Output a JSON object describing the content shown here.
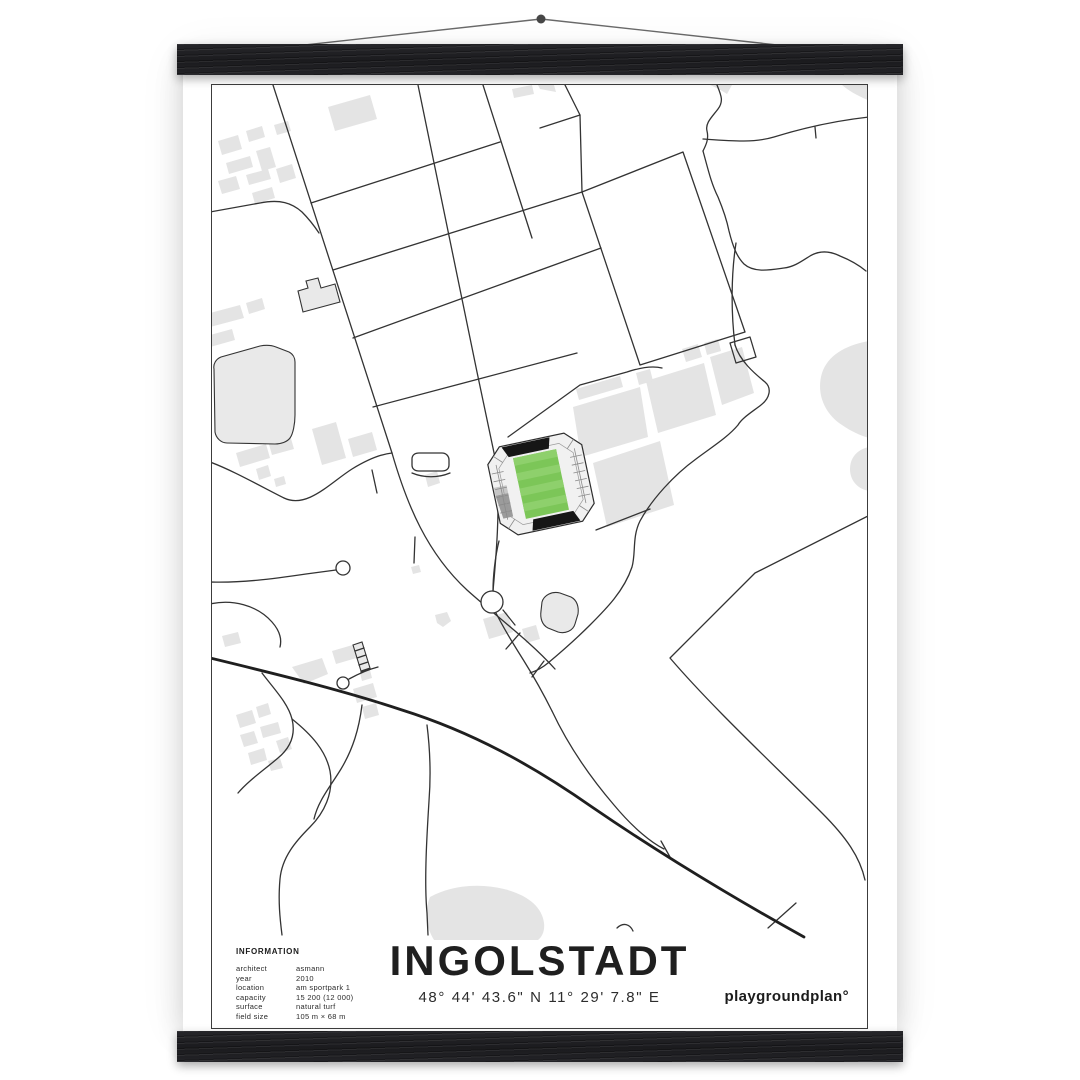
{
  "poster": {
    "title": "INGOLSTADT",
    "coordinates": "48° 44' 43.6\" N  11° 29' 7.8\" E",
    "brand": "playgroundplan°",
    "info": {
      "heading": "INFORMATION",
      "rows": [
        {
          "label": "architect",
          "value": "asmann"
        },
        {
          "label": "year",
          "value": "2010"
        },
        {
          "label": "location",
          "value": "am sportpark 1"
        },
        {
          "label": "capacity",
          "value": "15 200 (12 000)"
        },
        {
          "label": "surface",
          "value": "natural turf"
        },
        {
          "label": "field size",
          "value": "105 m × 68 m"
        }
      ]
    }
  },
  "colors": {
    "paper": "#ffffff",
    "bar": "#1e1e20",
    "road": "#333333",
    "road_dark": "#1f1f1f",
    "building": "#e4e4e4",
    "building_outlined": "#e9e9e9",
    "pitch": "#7cc658",
    "pitch_stripe": "#8ed06c",
    "stand_black": "#161616",
    "stand_gray": "#9b9b9b"
  },
  "map": {
    "viewbox": "0 0 655 855",
    "buildings": [
      "M6,56 L26,50 L30,64 L10,70 Z",
      "M34,46 L50,41 L53,52 L37,57 Z",
      "M14,78 L38,71 L41,82 L17,89 Z",
      "M44,66 L58,62 L64,82 L50,86 Z",
      "M6,96 L24,91 L28,104 L10,109 Z",
      "M34,90 L56,84 L59,94 L37,100 Z",
      "M62,40 L76,36 L79,46 L65,50 Z",
      "M64,84 L80,79 L84,93 L68,98 Z",
      "M40,108 L60,102 L63,113 L43,119 Z",
      "M116,22 L158,10 L165,34 L123,46 Z",
      "M300,4 L320,0 L322,9 L302,13 Z",
      "M326,0 L342,0 L344,7 L328,4 Z",
      "M630,0 L658,0 L658,16 C646,11 637,6 630,0 Z",
      "M498,0 L520,0 L515,9 C509,5 503,2 498,0 Z",
      "M-2,228 L28,220 L32,233 L-2,242 Z",
      "M34,218 L50,213 L53,224 L37,229 Z",
      "M-2,250 L20,244 L23,255 L-2,262 Z",
      "M24,368 L54,359 L58,373 L28,382 Z",
      "M56,356 L78,350 L82,364 L60,370 Z",
      "M100,344 L124,337 L134,373 L110,380 Z",
      "M136,354 L160,347 L165,365 L141,372 Z",
      "M44,384 L56,380 L59,391 L47,395 Z",
      "M62,394 L72,391 L74,399 L64,402 Z",
      "M213,390 L225,386 L228,398 L216,402 Z",
      "M199,482 L207,480 L209,487 L201,489 Z",
      "M24,630 L40,625 L44,638 L28,643 Z",
      "M44,622 L56,618 L59,629 L47,633 Z",
      "M28,650 L42,646 L46,658 L32,662 Z",
      "M48,642 L66,637 L69,648 L51,653 Z",
      "M64,656 L76,652 L80,664 L68,668 Z",
      "M36,668 L52,663 L55,675 L39,680 Z",
      "M56,676 L68,673 L71,683 L59,686 Z",
      "M10,551 L26,547 L29,558 L13,562 Z",
      "M80,582 L110,573 L116,589 L92,599 Z",
      "M120,566 L144,559 L148,572 L124,579 Z",
      "M148,588 L158,585 L160,593 L150,596 Z",
      "M141,604 L161,598 L165,612 L145,618 Z",
      "M150,622 L164,618 L167,630 L153,634 Z",
      "M271,534 L295,527 L301,547 L277,554 Z",
      "M310,544 L324,540 L328,554 L314,558 Z",
      "M223,530 L235,527 L239,536 L231,542 L225,538 Z",
      "M218,812 C240,800 268,798 292,804 C316,810 330,822 332,838 C333,846 330,852 326,855 L222,855 C214,842 212,826 218,812 Z",
      "M657,256 C634,260 616,270 610,288 C604,308 612,328 630,340 C640,347 650,351 657,353 Z",
      "M657,362 C646,364 638,372 638,384 C638,396 646,404 657,406 Z",
      "M364,304 L408,291 L411,302 L367,315 Z",
      "M361,322 L428,302 L436,352 L369,372 Z",
      "M434,296 L492,278 L504,330 L446,348 Z",
      "M498,272 L530,262 L542,308 L510,320 Z",
      "M381,378 L448,356 L462,420 L395,442 Z",
      "M424,288 L438,284 L441,296 L427,300 Z",
      "M470,264 L486,259 L490,272 L474,277 Z",
      "M492,258 L506,254 L509,266 L495,270 Z"
    ],
    "outlined": [
      "M2,284 C1,279 4,274 9,272 L48,261 C53,260 59,260 64,262 L77,267 C81,269 83,273 83,277 L83,330 C83,339 81,349 78,353 C75,357 69,359 63,359 L15,358 C9,358 4,353 3,347 Z",
      "M86,206 L96,203 L94,196 L106,193 L109,203 L123,199 L128,217 L91,227 Z",
      "M330,517 C332,510 340,506 348,508 L359,512 C365,515 367,522 366,529 L363,539 C361,546 353,549 346,547 L336,543 C330,540 328,533 329,526 Z",
      "M141,560 L150,557 L158,583 L149,586 Z"
    ],
    "roads_thin": [
      "M61,0 L180,368",
      "M-2,127 L48,118 C68,114 80,118 90,127 C98,135 103,142 107,148",
      "M99,118 L288,57",
      "M121,185 L370,107",
      "M141,253 L389,163",
      "M161,322 L365,268",
      "M206,0 L265,287 L285,382 C288,430 284,472 281,506",
      "M271,0 L320,153",
      "M353,0 L368,30 L328,43",
      "M368,30 L370,107",
      "M370,107 L471,67 L533,247 L428,280 Z",
      "M296,352 L368,300 L415,287 C430,282 442,281 450,283",
      "M180,368 C195,420 215,468 255,505 C285,532 318,556 343,584",
      "M308,548 L294,564",
      "M332,576 L320,592",
      "M-2,377 C20,385 50,402 72,413 C95,424 118,398 140,384 C158,373 170,369 180,368",
      "M-2,497 C30,498 60,494 94,489 L124,485",
      "M-2,519 C20,514 45,520 60,537 C68,546 70,554 68,562",
      "M160,385 L165,408",
      "M200,388 C212,393 226,393 238,388",
      "M203,452 L202,478",
      "M556,843 L584,818",
      "M405,843 C411,837 418,839 421,846",
      "M50,588 C62,604 76,618 80,634 C84,650 78,663 66,673 C52,685 36,696 26,708",
      "M80,634 C100,650 114,666 118,686 C122,708 112,728 98,742 C84,756 70,772 68,794 C66,816 68,834 70,850",
      "M150,620 C147,644 141,664 129,684 C118,702 106,716 102,734",
      "M215,640 C218,664 219,690 217,716 C215,748 212,796 215,828 L216,850",
      "M284,528 C293,546 302,560 312,576 C322,592 332,610 340,626",
      "M340,626 C356,660 378,692 402,720 C422,744 440,758 452,764",
      "M449,756 L458,772",
      "M281,506 C281,492 283,472 287,456",
      "M291,525 L303,540",
      "M658,430 C618,450 578,470 543,488 L458,573 C500,622 560,678 610,728 C634,752 648,772 653,795",
      "M523,260 C528,276 542,288 553,297 C560,303 558,313 549,320 C540,327 530,333 526,340 C516,352 500,362 484,374 C462,390 440,414 428,436 C420,452 424,468 420,482 C412,506 394,524 378,540 C364,554 348,568 336,578 C330,583 324,586 318,588",
      "M524,158 C519,190 519,228 523,260",
      "M505,0 C509,10 512,16 506,24 C500,32 493,38 495,46 C497,54 494,60 491,66",
      "M491,54 C520,56 542,58 562,52 C588,44 620,36 657,32",
      "M603,42 L604,53",
      "M491,66 C496,84 499,98 506,112 C511,124 515,136 517,146 C521,162 525,172 532,179 C542,188 558,185 572,183 C582,182 590,176 598,171 C608,165 618,166 628,171 C638,175 648,181 654,186",
      "M384,445 L438,424",
      "M137,594 C148,588 158,584 166,582",
      "M143,566 L152,563 M145,573 L154,570 M147,580 L156,577 M149,587 L158,584",
      "M518,258 L538,252 L544,272 L524,278 Z"
    ],
    "roads_thick": [
      "M-2,573 C60,588 130,605 190,625 C260,647 320,680 380,722 C450,770 520,812 592,852"
    ],
    "white_outlines": [
      "M291,517 A11,11 0 1 1 269,517 A11,11 0 1 1 291,517 Z",
      "M138,483 A7,7 0 1 1 124,483 A7,7 0 1 1 138,483 Z",
      "M137,598 A6,6 0 1 1 125,598 A6,6 0 1 1 137,598 Z",
      "M207,368 L230,368 C234,368 237,371 237,375 L237,380 C237,384 234,386 230,386 L207,386 C203,386 200,384 200,380 L200,374 C200,370 203,368 207,368 Z"
    ],
    "stadium": {
      "transform": "translate(329,399) rotate(-12)",
      "parts": [
        {
          "d": "M-33,-45 L33,-45 L48,-30 L48,30 L33,45 L-33,45 L-48,30 L-48,-30 Z",
          "f": "#f1f1f1",
          "s": "#2e2e2e",
          "w": 1.2
        },
        {
          "d": "M-47,2 L-34,2 L-34,26 L-44,26 Z",
          "f": "#9b9b9b"
        },
        {
          "d": "M-47,-6 L-34,-6 L-34,2 L-47,2 Z",
          "f": "#c6c6c6"
        },
        {
          "d": "M-46,-20 L-34,-20 M-46,-12 L-34,-12 M-46,-4 L-34,-4 M-46,4 L-34,4 M-46,12 L-34,12 M-46,20 L-34,20 M-40,-28 L-40,28 M34,-20 L46,-20 M34,-12 L46,-12 M34,-4 L46,-4 M34,4 L46,4 M34,12 L46,12 M34,20 L46,20 M40,-28 L40,28 M-41,-37 L-33,-29 M33,-29 L41,-37 M-41,37 L-33,29 M33,29 L41,37",
          "f": "none",
          "s": "#8a8a8a",
          "w": 0.8
        },
        {
          "d": "M-26,-36 L26,-36 L38,-24 L38,24 L26,36 L-26,36 L-38,24 L-38,-24 Z",
          "f": "none",
          "s": "#999999",
          "w": 0.7
        },
        {
          "d": "M-31,-44 L18,-44 L15,-33 L-26,-33 Z",
          "f": "#161616"
        },
        {
          "d": "M-15,33 L26,33 L31,44 L-18,44 Z",
          "f": "#161616"
        },
        {
          "d": "M-22,-31 L22,-31 L22,31 L-22,31 Z",
          "f": "#7cc658"
        },
        {
          "d": "M-22,-31 L22,-31 L22,-23.2 L-22,-23.2 Z",
          "f": "#8ed06c"
        },
        {
          "d": "M-22,-15.5 L22,-15.5 L22,-7.7 L-22,-7.7 Z",
          "f": "#8ed06c"
        },
        {
          "d": "M-22,0 L22,0 L22,7.8 L-22,7.8 Z",
          "f": "#8ed06c"
        },
        {
          "d": "M-22,15.5 L22,15.5 L22,23.3 L-22,23.3 Z",
          "f": "#8ed06c"
        }
      ]
    }
  }
}
